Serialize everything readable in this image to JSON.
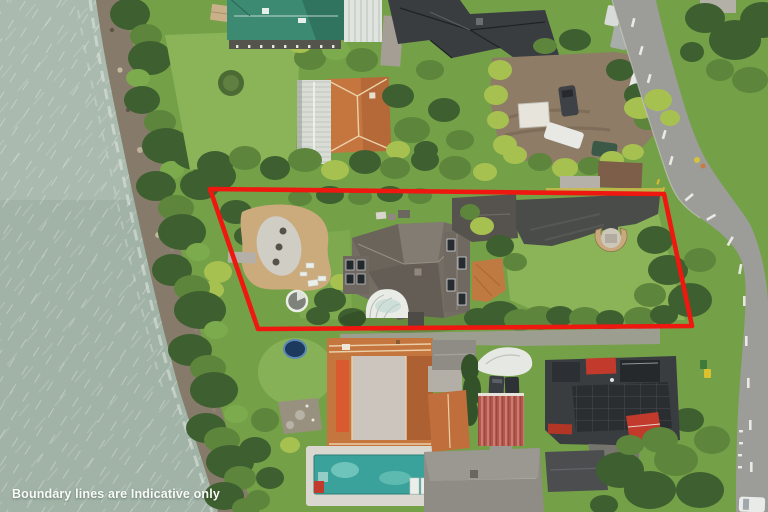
{
  "image": {
    "kind": "aerial-photograph-of-waterfront-property",
    "caption": "Boundary lines are Indicative only"
  },
  "overlay": {
    "boundary_points": "210,189 664,194 692,326 258,329",
    "boundary_color": "#ee1810",
    "boundary_stroke_width": "4.6"
  },
  "palette": {
    "water": "#a7b6ab",
    "grass": "#74a048",
    "lawn": "#8ab457",
    "road": "#9c9c98",
    "shore_rock": "#867b6a",
    "paver_tan": "#cbaa7c",
    "driveway_asphalt": "#4a4c49",
    "roof_green_metal": "#3c8a72",
    "roof_terracotta": "#c5763f",
    "roof_charcoal": "#3a3d40",
    "roof_grey_main_house": "#746d64",
    "roof_red_shed": "#b5574c",
    "accent_red_roof": "#c13a2c",
    "pool_water": "#3aa29a",
    "trampoline_blue": "#1c3a5e",
    "caption_color": "#f8faf7"
  },
  "features": [
    "sea-water",
    "rocky-shoreline",
    "shoreline-trees",
    "green-metal-roof-house",
    "white-gable-roof-house",
    "terracotta-roof-house",
    "black-roof-mansion",
    "gravel-parking-area",
    "parked-cars",
    "street",
    "street-markings",
    "red-boundary-overlay",
    "paved-courtyard",
    "gravel-oval-garden",
    "spa-pool",
    "main-house-grey-roof",
    "roof-skylights",
    "curved-conservatory",
    "garage",
    "dark-driveway",
    "stone-semicircle-patio",
    "yellow-hedge-strip",
    "trampoline",
    "rear-lane",
    "terracotta-villa-with-flat-roof-deck",
    "orange-awning",
    "swimming-pool",
    "sun-loungers",
    "red-pool-mat",
    "boat-under-white-cover",
    "red-corrugated-shed",
    "cypress-hedge",
    "charcoal-modern-house",
    "red-roof-accents",
    "solar-panel-roof",
    "grey-gable-house",
    "rubbish-bins",
    "white-parked-car",
    "grass-verge",
    "street-trees"
  ]
}
